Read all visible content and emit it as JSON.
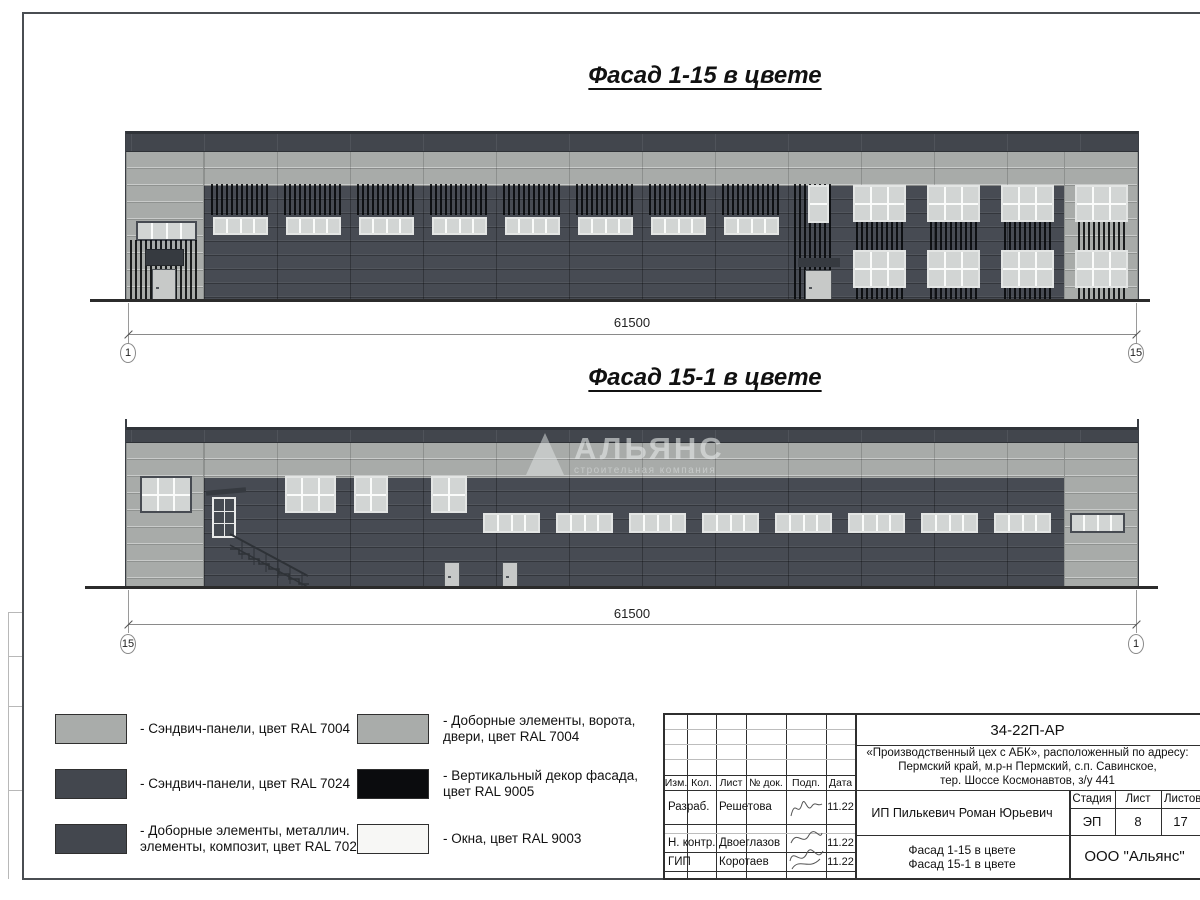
{
  "sheet": {
    "facade_top": {
      "title": "Фасад 1-15 в цвете",
      "dimension": "61500",
      "axis_left": "1",
      "axis_right": "15"
    },
    "facade_bottom": {
      "title": "Фасад 15-1 в цвете",
      "dimension": "61500",
      "axis_left": "15",
      "axis_right": "1"
    },
    "watermark": {
      "name": "АЛЬЯНС",
      "subtitle": "строительная компания"
    },
    "legend": {
      "items": [
        {
          "label": "- Сэндвич-панели, цвет RAL 7004",
          "color": "#a9acaa"
        },
        {
          "label": "- Сэндвич-панели, цвет RAL 7024",
          "color": "#43474e"
        },
        {
          "label": "- Доборные элементы, металлич.\nэлементы, композит, цвет RAL 7024",
          "color": "#43474e"
        },
        {
          "label": "- Доборные элементы, ворота,\nдвери, цвет RAL 7004",
          "color": "#a9acaa"
        },
        {
          "label": "- Вертикальный декор фасада,\nцвет RAL 9005",
          "color": "#0b0c0e"
        },
        {
          "label": "- Окна, цвет RAL 9003",
          "color": "#f7f7f5"
        }
      ]
    },
    "title_block": {
      "doc_code": "34-22П-АР",
      "project_line1": "«Производственный цех с АБК», расположенный по адресу:",
      "project_line2": "Пермский край, м.р-н Пермский, с.п. Савинское,",
      "project_line3": "тер. Шоссе Космонавтов, з/у 441",
      "client": "ИП Пилькевич Роман Юрьевич",
      "columns": [
        "Изм.",
        "Кол.",
        "Лист",
        "№ док.",
        "Подп.",
        "Дата"
      ],
      "stage_label": "Стадия",
      "sheet_label": "Лист",
      "sheets_label": "Листов",
      "stage": "ЭП",
      "sheet_no": "8",
      "sheets_total": "17",
      "roles": [
        {
          "role": "Разраб.",
          "name": "Решетова",
          "date": "11.22"
        },
        {
          "role": "Н. контр.",
          "name": "Двоеглазов",
          "date": "11.22"
        },
        {
          "role": "ГИП",
          "name": "Коротаев",
          "date": "11.22"
        }
      ],
      "sheet_name_line1": "Фасад 1-15 в цвете",
      "sheet_name_line2": "Фасад 15-1 в цвете",
      "organization": "ООО \"Альянс\""
    },
    "colors": {
      "ral7004": "#a9acaa",
      "ral7024": "#474b53",
      "ral9005": "#0b0c0e",
      "ral9003": "#f7f7f5",
      "parapet": "#42464d"
    }
  }
}
